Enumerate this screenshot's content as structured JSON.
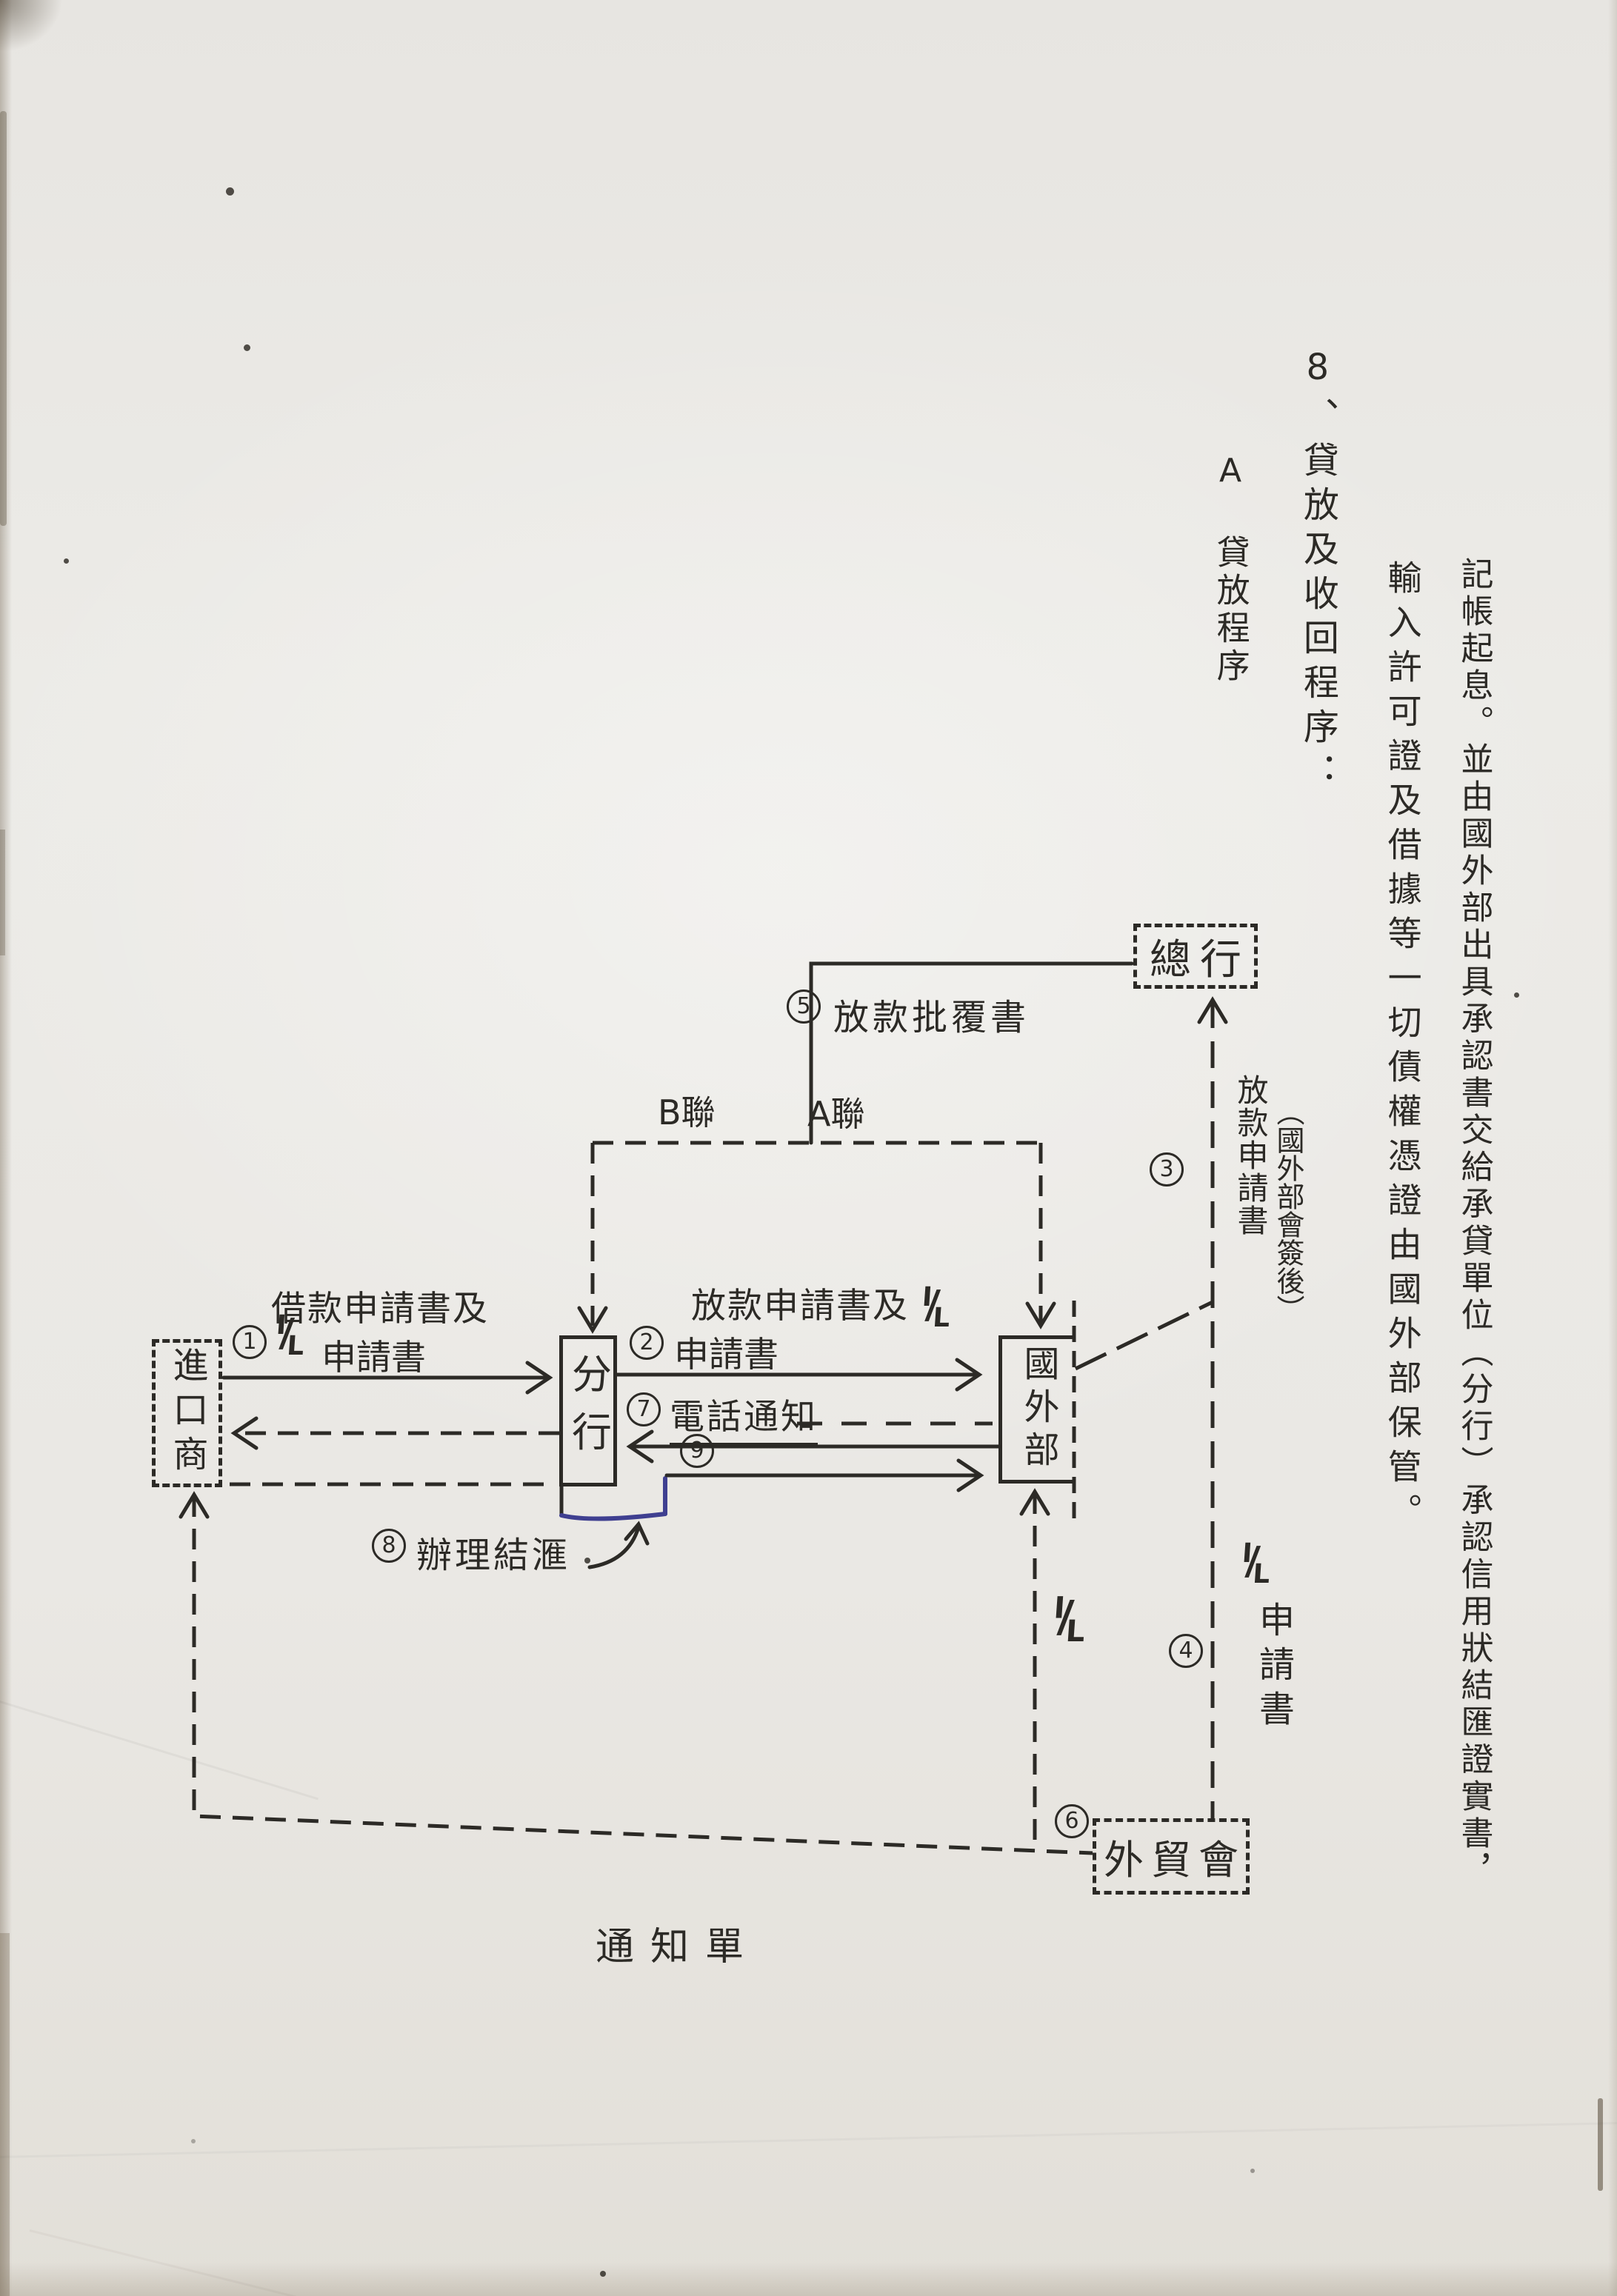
{
  "document": {
    "kind": "scanned lending-procedure flow diagram page",
    "ink_color": "#2c2a26",
    "pen_color": "#3f3f90",
    "paper_color": "#e9e7e3"
  },
  "body_text": {
    "col1": "記帳起息。並由國外部出具承認書交給承貸單位（分行）承認信用狀結匯證實書，",
    "col2": "輸入許可證及借據等一切債權憑證由國外部保管。",
    "col3_num": "8、",
    "col3": "貸放及收回程序：",
    "col4_marker": "A",
    "col4": "貸放程序"
  },
  "diagram": {
    "nodes": {
      "head_office": "總行",
      "branch": "分行",
      "foreign_dept": "國外部",
      "importer": "進口商",
      "trade_council": "外貿會"
    },
    "steps": {
      "s1": "1",
      "s2": "2",
      "s3": "3",
      "s4": "4",
      "s5": "5",
      "s6": "6",
      "s7": "7",
      "s8": "8",
      "s9": "9"
    },
    "labels": {
      "il_top": "I",
      "il_slash": "/",
      "il_bottom": "L",
      "loan_approval": "放款批覆書",
      "copy_b": "B聯",
      "copy_a": "A聯",
      "borrow_request_l1": "借款申請書及",
      "request_doc": "申請書",
      "lend_request_l1": "放款申請書及",
      "phone_notice": "電話通知",
      "settle_fx": "辦理結滙",
      "loan_application": "放款申請書",
      "countersigned": "（國外部會簽後）",
      "il_application": "申請書",
      "notice_slip": "通知單"
    }
  }
}
